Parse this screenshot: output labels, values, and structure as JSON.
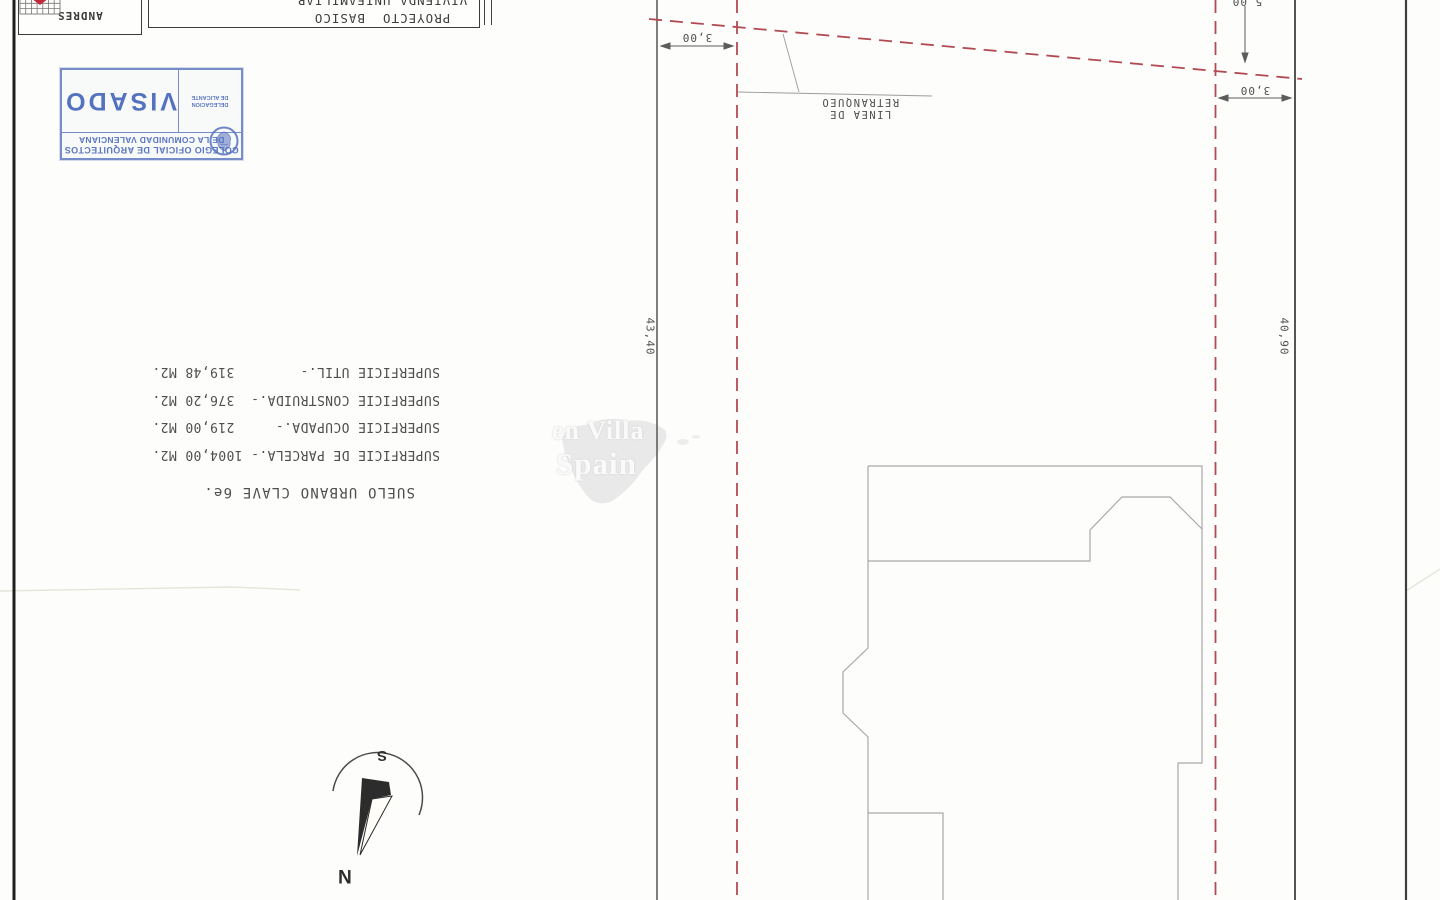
{
  "colors": {
    "setback_red": "#b24a54",
    "boundary_gray": "#5e5e5e",
    "building_gray": "#a9a9a9",
    "stamp_blue": "#5b77c2",
    "logo_red": "#c22a3a"
  },
  "title_block": {
    "firm": "ANDRES",
    "line1": "VIVIENDA UNIFAMILIAR",
    "line2": "PROYECTO  BASICO"
  },
  "stamp": {
    "org_line1": "COLEGIO OFICIAL DE ARQUITECTOS",
    "org_line2": "DE LA COMUNIDAD VALENCIANA",
    "delegation_line1": "DELEGACION",
    "delegation_line2": "DE ALICANTE",
    "word": "VISADO"
  },
  "surfaces": {
    "zoning": "SUELO URBANO CLAVE 6e.",
    "lines": [
      "SUPERFICIE DE PARCELA.- 1004,00 M2.",
      "SUPERFICIE OCUPADA.-     219,00 M2.",
      "SUPERFICIE CONSTRUIDA.-  376,20 M2.",
      "SUPERFICIE UTIL.-        319,48 M2."
    ]
  },
  "plan": {
    "setback_label": "LINEA DE RETRANQUEO",
    "dim_front_left": "3,00",
    "dim_top_right": "5,00",
    "dim_side_right": "3,00",
    "dim_length_left": "43,40",
    "dim_length_right": "40,90"
  },
  "compass": {
    "south": "S",
    "north": "N"
  },
  "watermark": {
    "line1": "en Villa",
    "line2": "Spain"
  }
}
